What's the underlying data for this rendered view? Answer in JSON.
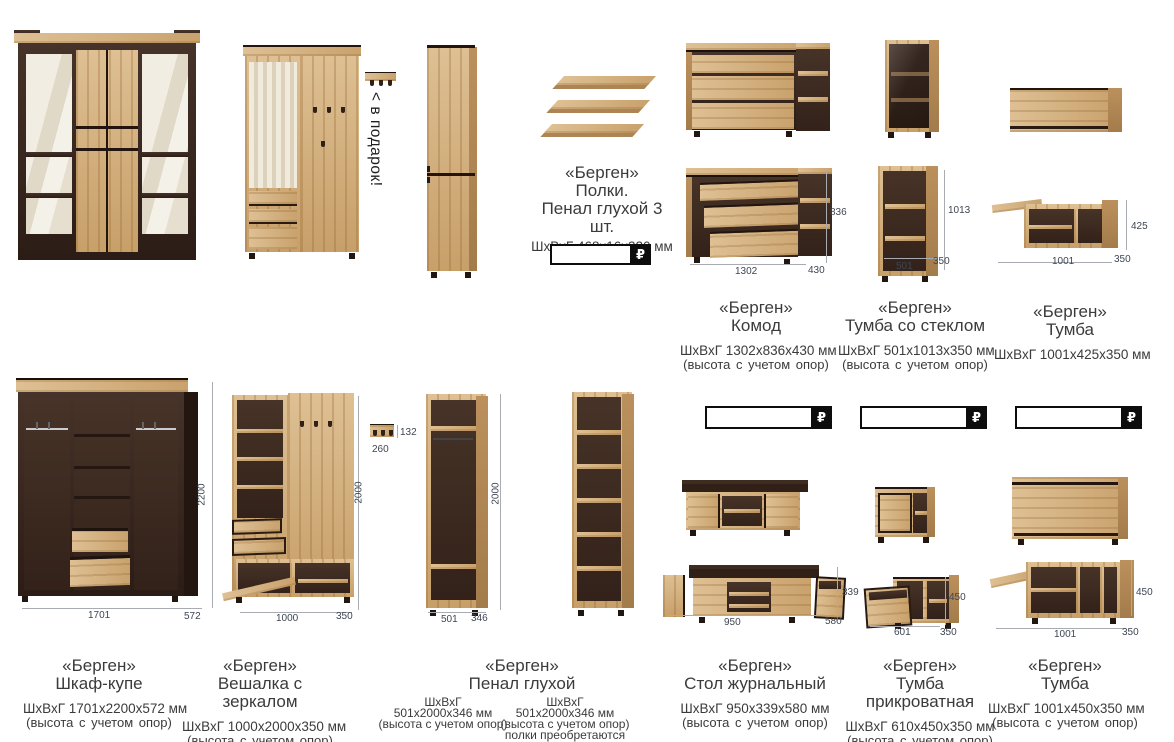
{
  "gift": {
    "text": "< в подарок!"
  },
  "currency_badge": "₽",
  "shelves": {
    "brand": "«Берген»",
    "name1": "Полки.",
    "name2": "Пенал глухой 3 шт.",
    "dims": "ШхВхГ  468х16х320  мм"
  },
  "products": {
    "komod": {
      "brand": "«Берген»",
      "name": "Комод",
      "dims": "ШхВхГ 1302х836х430 мм",
      "note": "(высота с учетом опор)",
      "h": "836",
      "w": "1302",
      "d": "430"
    },
    "tumba_glass": {
      "brand": "«Берген»",
      "name": "Тумба со стеклом",
      "dims": "ШхВхГ 501х1013х350 мм",
      "note": "(высота с учетом опор)",
      "h": "1013",
      "w": "501",
      "d": "350"
    },
    "tumba_wall": {
      "brand": "«Берген»",
      "name": "Тумба",
      "dims": "ШхВхГ 1001х425х350 мм",
      "h": "425",
      "w": "1001",
      "d": "350"
    },
    "shkaf": {
      "brand": "«Берген»",
      "name": "Шкаф-купе",
      "dims": "ШхВхГ 1701х2200х572 мм",
      "note": "(высота с учетом опор)",
      "h": "2200",
      "w": "1701",
      "d": "572"
    },
    "veshalka": {
      "brand": "«Берген»",
      "name": "Вешалка с зеркалом",
      "dims": "ШхВхГ 1000х2000х350 мм",
      "note": "(высота с учетом опор)",
      "h": "2000",
      "w": "1000",
      "d": "350",
      "hanger_w": "260",
      "hanger_h": "132"
    },
    "penal": {
      "brand": "«Берген»",
      "name": "Пенал глухой",
      "h": "2000",
      "w": "501",
      "d": "346",
      "left": {
        "l1": "ШхВхГ",
        "l2": "501х2000х346 мм",
        "l3": "(высота с учетом опор)"
      },
      "right": {
        "l1": "ШхВхГ",
        "l2": "501х2000х346 мм",
        "l3": "(высота с учетом опор)",
        "l4": "полки преобретаются"
      }
    },
    "stol": {
      "brand": "«Берген»",
      "name": "Стол журнальный",
      "dims": "ШхВхГ 950х339х580 мм",
      "note": "(высота с учетом опор)",
      "h": "339",
      "w": "950",
      "d": "580"
    },
    "tumba_bed": {
      "brand": "«Берген»",
      "name": "Тумба  прикроватная",
      "dims": "ШхВхГ  610х450х350  мм",
      "note": "(высота с учетом опор)",
      "h": "450",
      "w": "601",
      "d": "350"
    },
    "tumba_low": {
      "brand": "«Берген»",
      "name": "Тумба",
      "dims": "ШхВхГ 1001х450х350 мм",
      "note": "(высота с учетом опор)",
      "h": "450",
      "w": "1001",
      "d": "350"
    }
  }
}
